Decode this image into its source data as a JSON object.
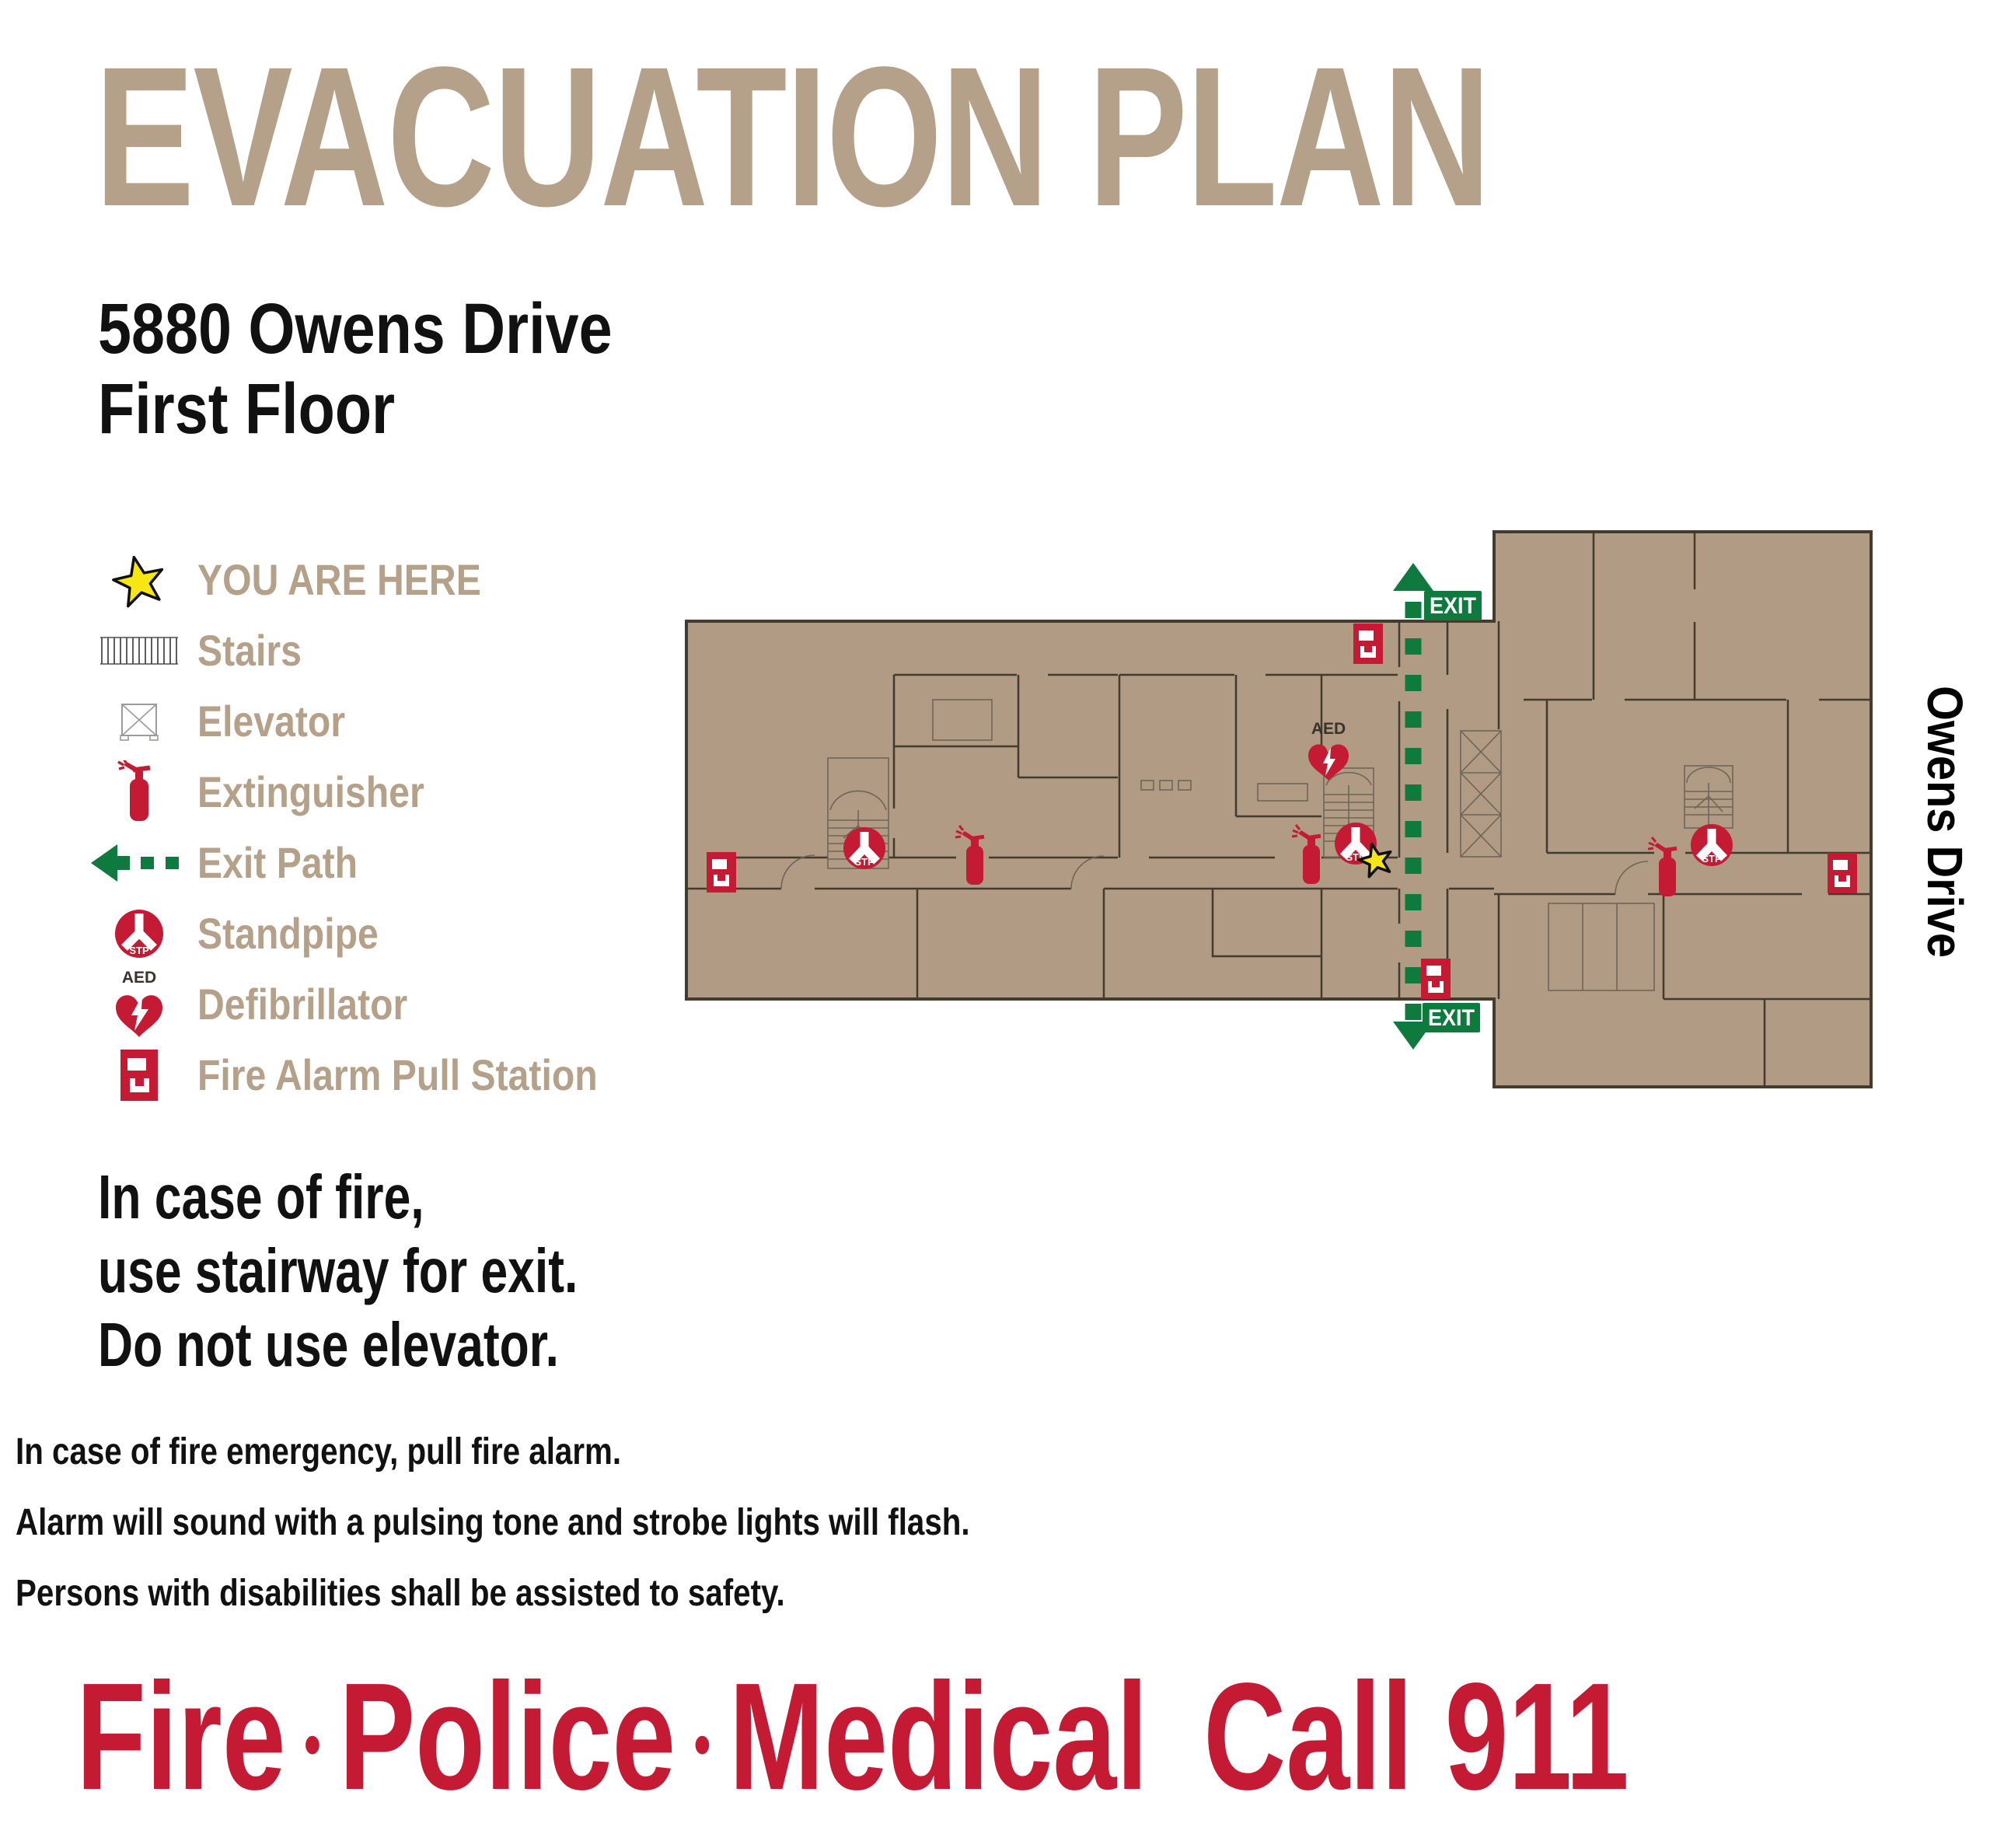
{
  "title": "EVACUATION PLAN",
  "address": {
    "line1": "5880 Owens Drive",
    "line2": "First Floor"
  },
  "legend": {
    "items": [
      {
        "icon": "you-are-here-star-icon",
        "label": "YOU ARE HERE"
      },
      {
        "icon": "stairs-icon",
        "label": "Stairs"
      },
      {
        "icon": "elevator-icon",
        "label": "Elevator"
      },
      {
        "icon": "extinguisher-icon",
        "label": "Extinguisher"
      },
      {
        "icon": "exit-path-icon",
        "label": "Exit Path"
      },
      {
        "icon": "standpipe-icon",
        "label": "Standpipe"
      },
      {
        "icon": "defibrillator-icon",
        "label": "Defibrillator"
      },
      {
        "icon": "fire-alarm-pull-station-icon",
        "label": "Fire Alarm Pull Station"
      }
    ]
  },
  "map": {
    "street_label": "Owens Drive",
    "exit_label": "EXIT",
    "stp_label": "STP",
    "aed_label": "AED",
    "colors": {
      "floor_fill": "#b19b85",
      "wall": "#433b2d",
      "emergency_red": "#c41a33",
      "exit_green": "#0e7a3e",
      "star_yellow": "#f7e616",
      "tan": "#b5a189"
    }
  },
  "instructions": {
    "headline": [
      "In case of fire,",
      "use stairway for exit.",
      "Do not use elevator."
    ]
  },
  "notes": [
    "In case of fire emergency, pull fire alarm.",
    "Alarm will sound with a pulsing tone and strobe lights will flash.",
    "Persons with disabilities shall be assisted to safety."
  ],
  "banner": {
    "items": [
      "Fire",
      "Police",
      "Medical"
    ],
    "separator": "•",
    "call_text": "Call 911"
  }
}
